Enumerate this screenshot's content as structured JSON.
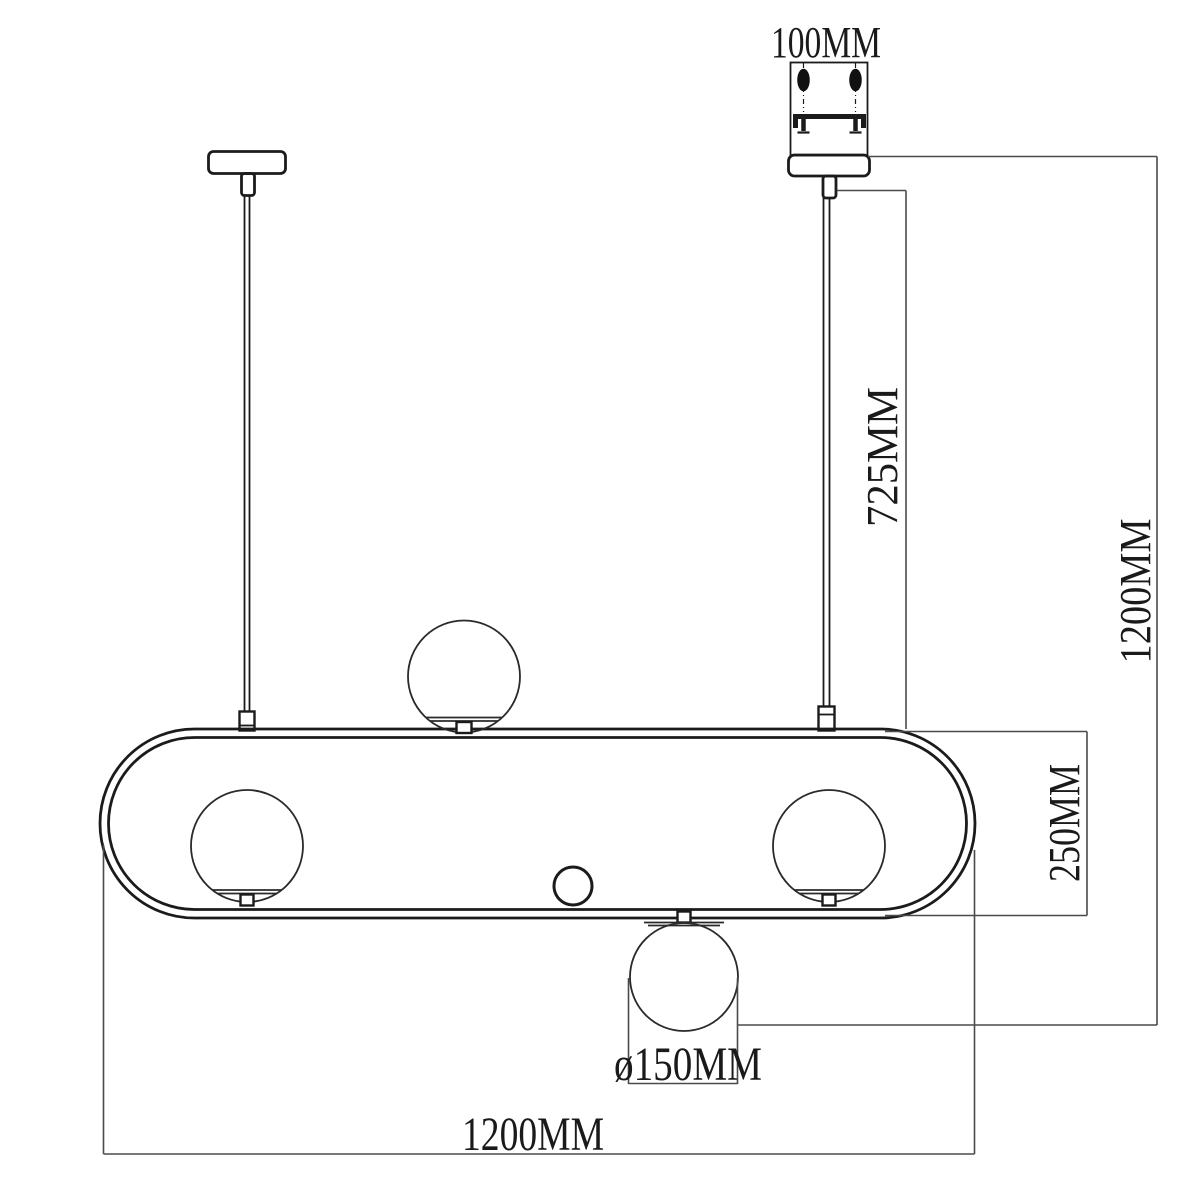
{
  "drawing": {
    "labels": {
      "canopy_width": "100MM",
      "rod_drop": "725MM",
      "overall_drop": "1200MM",
      "frame_height": "250MM",
      "globe_diameter": "ø150MM",
      "overall_width": "1200MM"
    },
    "colors": {
      "background": "#ffffff",
      "fixture_line": "#1b1b1b",
      "dimension_line": "#4a4a4a",
      "text": "#1a1a1a"
    }
  }
}
